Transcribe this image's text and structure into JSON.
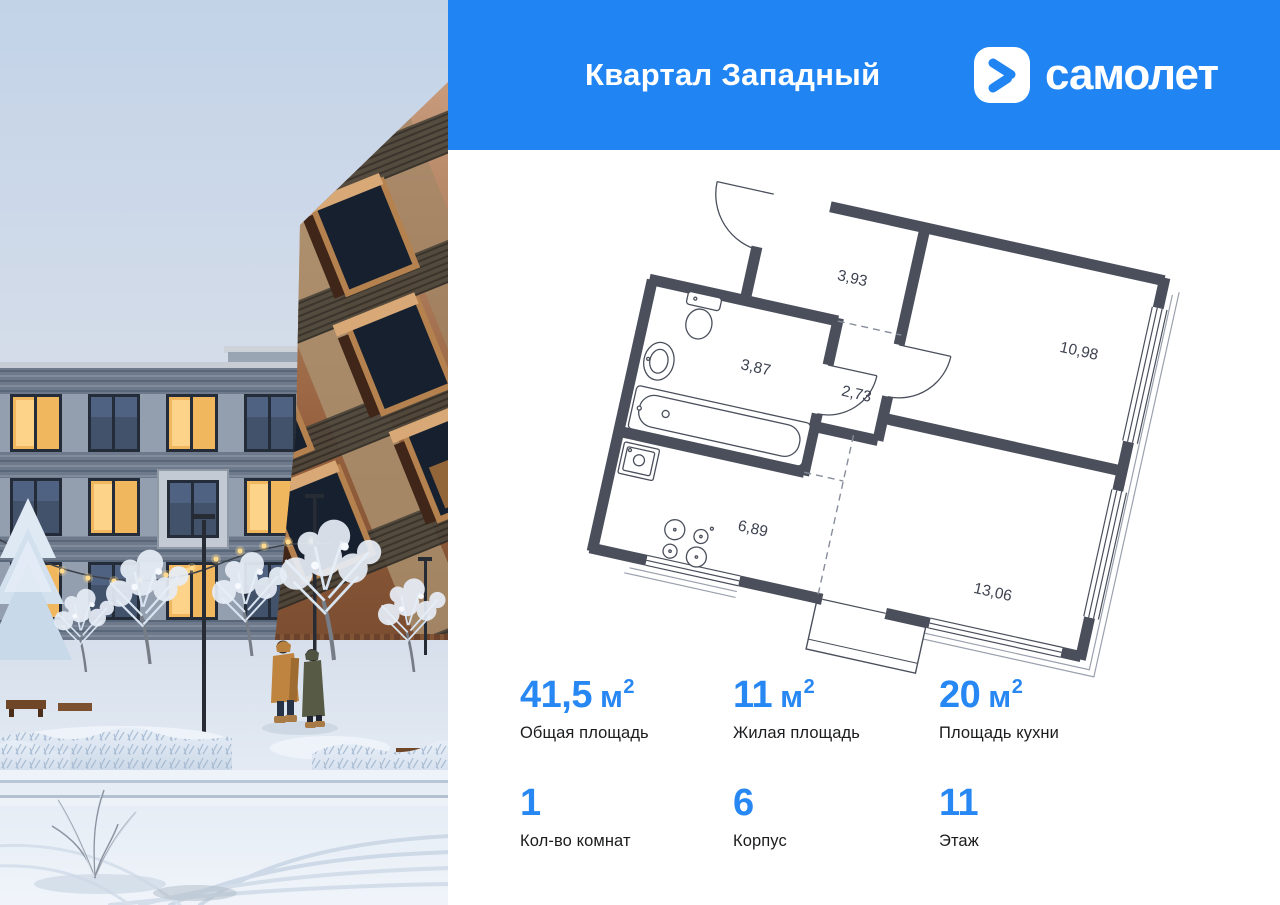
{
  "colors": {
    "header_bg": "#2085F2",
    "accent_blue": "#2787F3",
    "plan_wall": "#4A4F5B",
    "plan_label_color": "#3D4250"
  },
  "header": {
    "title": "Квартал Западный",
    "brand": "самолет",
    "logo_icon": "samolet-chevron-icon"
  },
  "floor_plan": {
    "rooms": [
      {
        "id": "hallway",
        "area": "3,93"
      },
      {
        "id": "bedroom",
        "area": "10,98"
      },
      {
        "id": "bathroom",
        "area": "3,87"
      },
      {
        "id": "corridor",
        "area": "2,73"
      },
      {
        "id": "kitchen",
        "area": "6,89"
      },
      {
        "id": "living-room",
        "area": "13,06"
      }
    ],
    "fixtures": [
      "toilet",
      "sink",
      "bathtub",
      "kitchen-sink",
      "stove",
      "balcony"
    ]
  },
  "stats": {
    "row1": [
      {
        "value": "41,5",
        "unit": "м",
        "sup": "2",
        "label": "Общая площадь"
      },
      {
        "value": "11",
        "unit": "м",
        "sup": "2",
        "label": "Жилая площадь"
      },
      {
        "value": "20",
        "unit": "м",
        "sup": "2",
        "label": "Площадь кухни"
      }
    ],
    "row2": [
      {
        "value": "1",
        "unit": "",
        "sup": "",
        "label": "Кол-во комнат"
      },
      {
        "value": "6",
        "unit": "",
        "sup": "",
        "label": "Корпус"
      },
      {
        "value": "11",
        "unit": "",
        "sup": "",
        "label": "Этаж"
      }
    ]
  },
  "photo": {
    "scene": "winter-courtyard-render"
  }
}
